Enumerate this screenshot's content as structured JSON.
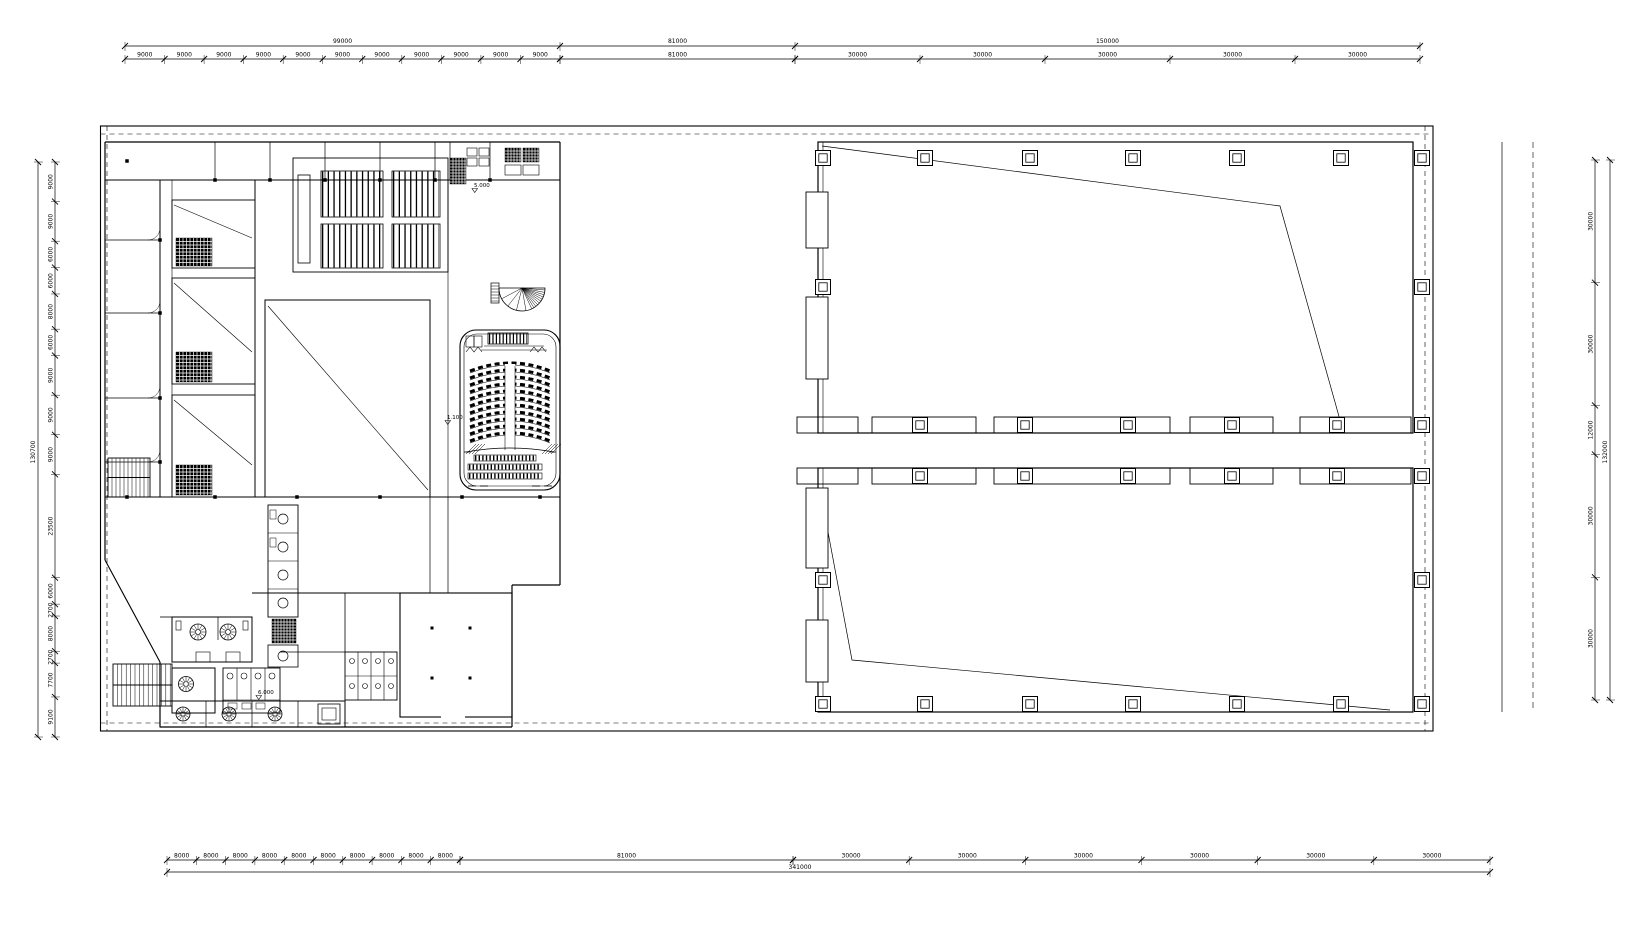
{
  "colors": {
    "line": "#000000",
    "background": "#ffffff"
  },
  "dimensions": {
    "top": {
      "groups": [
        {
          "total": "99000",
          "segments": [
            "9000",
            "9000",
            "9000",
            "9000",
            "9000",
            "9000",
            "9000",
            "9000",
            "9000",
            "9000",
            "9000"
          ]
        },
        {
          "total": "81000",
          "segments": [
            "81000"
          ]
        },
        {
          "total": "150000",
          "segments": [
            "30000",
            "30000",
            "30000",
            "30000",
            "30000"
          ]
        }
      ]
    },
    "bottom": {
      "total": "341000",
      "groups": [
        {
          "segments": [
            "8000",
            "8000",
            "8000",
            "8000",
            "8000",
            "8000",
            "8000",
            "8000",
            "8000",
            "8000"
          ]
        },
        {
          "segments": [
            "81000"
          ]
        },
        {
          "segments": [
            "30000",
            "30000",
            "30000",
            "30000",
            "30000",
            "30000"
          ]
        }
      ]
    },
    "left": {
      "total": "130700",
      "segments": [
        "9000",
        "9000",
        "6000",
        "6000",
        "8000",
        "6000",
        "9000",
        "9000",
        "9000",
        "23500",
        "6000",
        "2700",
        "8000",
        "2700",
        "7700",
        "9100"
      ]
    },
    "right": {
      "total": "132000",
      "segments": [
        "30000",
        "30000",
        "12000",
        "30000",
        "30000"
      ]
    }
  },
  "elevations": [
    {
      "label": "5.000"
    },
    {
      "label": "1.100"
    },
    {
      "label": "6.000"
    }
  ]
}
